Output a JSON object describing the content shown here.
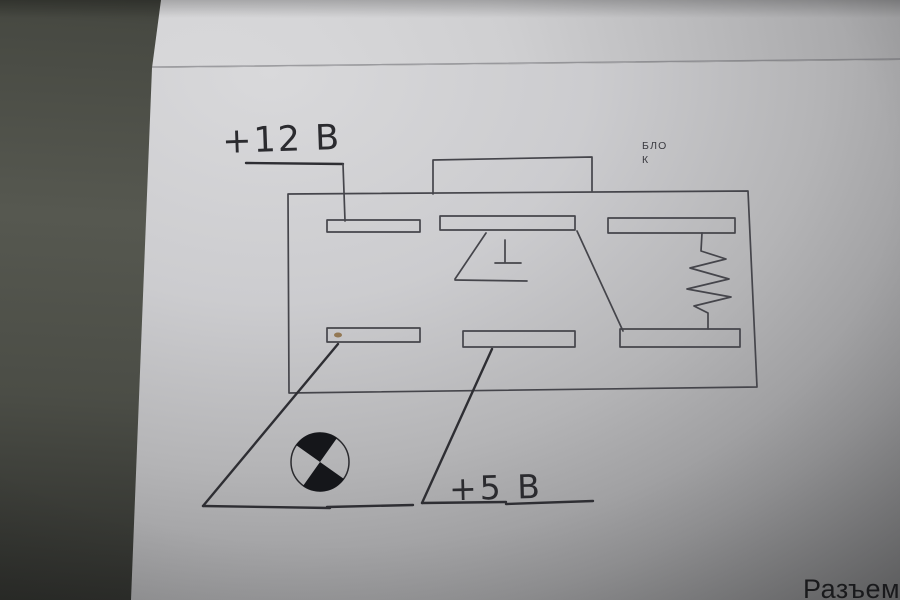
{
  "labels": {
    "supply_12v": "+12 В",
    "supply_5v": "+5 В",
    "block_line1": "БЛО",
    "block_line2": "К",
    "caption": "Разъем"
  },
  "symbols": {
    "ground": "ground-symbol",
    "resistor": "resistor-symbol",
    "center_mark": "center-mark-symbol"
  },
  "colors": {
    "ink": "#45454b",
    "handwriting": "#2b2b2f",
    "mark_fill": "#15161a",
    "paper_highlight": "#d9d9db",
    "paper_shadow": "#525254",
    "surface": "#565850"
  }
}
